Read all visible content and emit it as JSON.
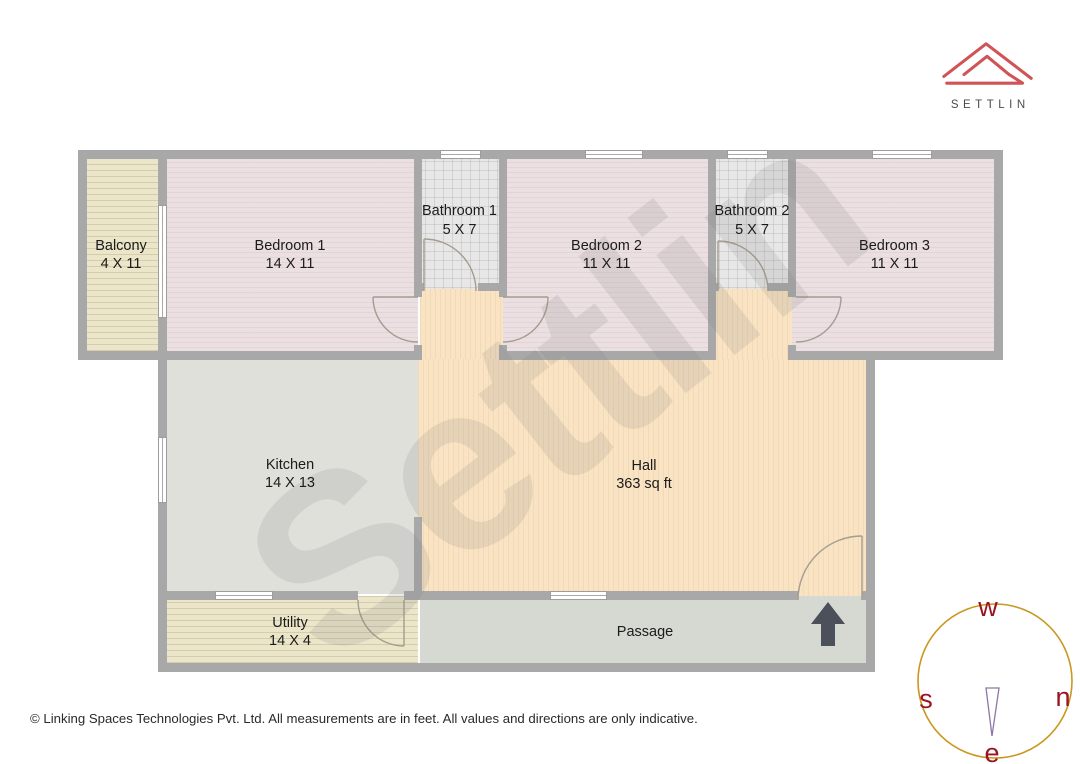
{
  "logo": {
    "text": "SETTLIN",
    "accent_color": "#d05355",
    "text_color": "#4c4c4c"
  },
  "watermark": {
    "text": "Settlin"
  },
  "rooms": {
    "balcony": {
      "label": "Balcony",
      "size": "4 X 11"
    },
    "bedroom1": {
      "label": "Bedroom 1",
      "size": "14 X 11"
    },
    "bathroom1": {
      "label": "Bathroom 1",
      "size": "5 X 7"
    },
    "bedroom2": {
      "label": "Bedroom 2",
      "size": "11 X 11"
    },
    "bathroom2": {
      "label": "Bathroom 2",
      "size": "5 X 7"
    },
    "bedroom3": {
      "label": "Bedroom 3",
      "size": "11 X 11"
    },
    "kitchen": {
      "label": "Kitchen",
      "size": "14 X 13"
    },
    "hall": {
      "label": "Hall",
      "size": "363 sq ft"
    },
    "utility": {
      "label": "Utility",
      "size": "14 X 4"
    },
    "passage": {
      "label": "Passage",
      "size": ""
    }
  },
  "compass": {
    "top": "w",
    "right": "n",
    "left": "s",
    "bottom": "e",
    "ring_color": "#c9981f",
    "letter_color": "#9c1322",
    "needle_color": "#8f76a5"
  },
  "footer": {
    "copyright": "© Linking Spaces Technologies Pvt. Ltd. All measurements are in feet. All values and directions are only indicative."
  }
}
